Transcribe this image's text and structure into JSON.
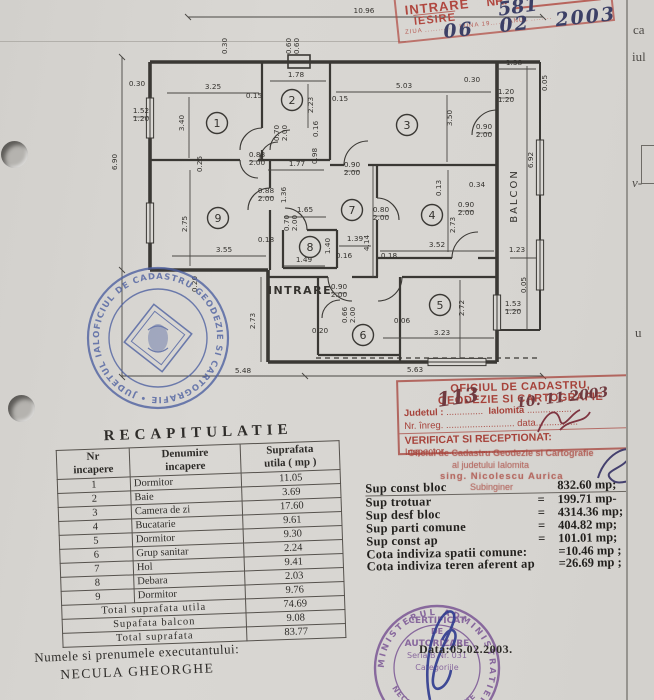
{
  "colors": {
    "stamp_red": "#b0473f",
    "stamp_blue": "#4c5fa0",
    "stamp_purple": "#7b5795",
    "signature_blue": "#2e3a8e",
    "ink": "#2e2c29"
  },
  "intake_stamp": {
    "intrare": "INTRARE",
    "iesire": "IESIRE",
    "nr_label": "NR.",
    "nr_value": "581",
    "tiny_row": "ZIUA ............  LUNA 19......  ANUL ........",
    "day": "06",
    "month": "02",
    "year": "2003"
  },
  "plan": {
    "entrance": "INTRARE",
    "balcony": "BALCON",
    "rooms": [
      "1",
      "2",
      "3",
      "4",
      "5",
      "6",
      "7",
      "8",
      "9"
    ],
    "dims": [
      "10.96",
      "6.90",
      "5.48",
      "5.63",
      "2.73",
      "6.92",
      "0.30",
      "0.30",
      "0.60",
      "0.60",
      "3.25",
      "0.15",
      "3.40",
      "1.52",
      "1.20",
      "0.25",
      "1.78",
      "2.23",
      "0.16",
      "0.70",
      "2.00",
      "5.03",
      "0.15",
      "3.50",
      "0.30",
      "1.38",
      "1.20",
      "1.20",
      "0.90",
      "2.00",
      "0.05",
      "0.88",
      "2.00",
      "1.77",
      "0.98",
      "0.90",
      "2.00",
      "0.88",
      "2.00",
      "1.36",
      "1.65",
      "0.70",
      "2.00",
      "0.80",
      "2.00",
      "0.90",
      "2.00",
      "2.73",
      "3.52",
      "0.18",
      "0.13",
      "0.34",
      "1.39",
      "4.14",
      "0.16",
      "1.40",
      "1.49",
      "2.75",
      "3.55",
      "0.18",
      "0.20",
      "0.90",
      "2.00",
      "0.66",
      "2.00",
      "0.06",
      "0.20",
      "2.72",
      "3.23",
      "1.53",
      "1.20",
      "0.05",
      "1.23"
    ]
  },
  "cadastru_stamp": {
    "title1": "OFICIUL DE CADASTRU,",
    "title2": "GEODEZIE SI CARTOGRAFIE",
    "judet_label": "Judetul :",
    "judet_value": "Ialomita",
    "judet_hand": "113",
    "date_hand": "10. 11 2003",
    "nr_line": "Nr. înreg. .......................... data................",
    "verificat": "VERIFICAT SI RECEPTIONAT:",
    "inspector": "Inspector, ..........................",
    "sub1": "Oficiul de Cadastru Geodezie si Cartografie",
    "sub2": "al judetului Ialomita",
    "sub3": "sing. Nicolescu Aurica",
    "sub4": "Subinginer"
  },
  "recap": {
    "title": "RECAPITULATIE",
    "headers": {
      "col1a": "Nr",
      "col1b": "incapere",
      "col2a": "Denumire",
      "col2b": "incapere",
      "col3a": "Suprafata",
      "col3b": "utila ( mp )"
    },
    "rows": [
      {
        "nr": "1",
        "name": "Dormitor",
        "area": "11.05"
      },
      {
        "nr": "2",
        "name": "Baie",
        "area": "3.69"
      },
      {
        "nr": "3",
        "name": "Camera de zi",
        "area": "17.60"
      },
      {
        "nr": "4",
        "name": "Bucatarie",
        "area": "9.61"
      },
      {
        "nr": "5",
        "name": "Dormitor",
        "area": "9.30"
      },
      {
        "nr": "6",
        "name": "Grup sanitar",
        "area": "2.24"
      },
      {
        "nr": "7",
        "name": "Hol",
        "area": "9.41"
      },
      {
        "nr": "8",
        "name": "Debara",
        "area": "2.03"
      },
      {
        "nr": "9",
        "name": "Dormitor",
        "area": "9.76"
      }
    ],
    "totals": [
      {
        "label": "Total suprafata utila",
        "value": "74.69"
      },
      {
        "label": "Supafata balcon",
        "value": "9.08"
      },
      {
        "label": "Total suprafata",
        "value": "83.77"
      }
    ]
  },
  "executor": {
    "label": "Numele si prenumele executantului:",
    "name": "NECULA GHEORGHE"
  },
  "summary": {
    "rows": [
      {
        "label": "Sup const bloc",
        "eq": "",
        "value": "832.60 mp;"
      },
      {
        "label": "Sup trotuar",
        "eq": "=",
        "value": "199.71 mp-"
      },
      {
        "label": "Sup desf bloc",
        "eq": "=",
        "value": "4314.36 mp;"
      },
      {
        "label": "Sup parti comune",
        "eq": "=",
        "value": "404.82 mp;"
      },
      {
        "label": "Sup const ap",
        "eq": "=",
        "value": "101.01 mp;"
      },
      {
        "label": "Cota indiviza spatii comune:",
        "eq": "",
        "value": "=10.46 mp ;"
      },
      {
        "label": "Cota indiviza teren aferent ap",
        "eq": "",
        "value": "=26.69 mp ;"
      }
    ]
  },
  "blue_stamp": {
    "ring_text": "OFICIUL DE CADASTRU GEODEZIE SI CARTOGRAFIE • JUDETUL IALOMITA •"
  },
  "purple_stamp": {
    "ring_text": "MINISTERUL  ADMINISTRATIEI  PUBLICE",
    "line1": "CERTIFICAT",
    "line2": "DE",
    "line3": "AUTORIZARE",
    "line4": "Seria B Nr. 031",
    "line5": "Categoriile",
    "name": "NECULA GHEORGHE",
    "date_text": "Data:05.02.2003."
  },
  "page_edge": {
    "fragments": [
      "ca",
      "iul",
      "v-",
      "u"
    ]
  }
}
